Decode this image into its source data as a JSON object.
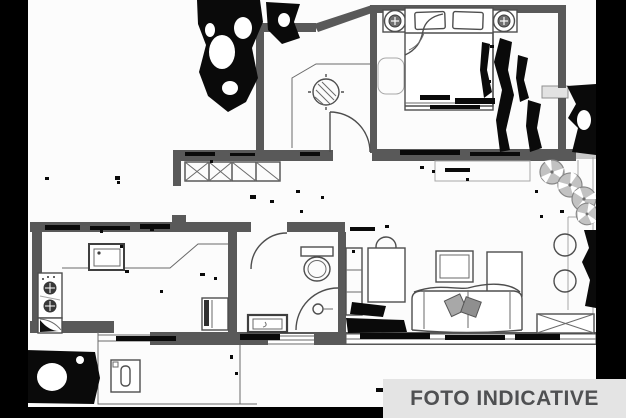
{
  "watermark": {
    "label": "FOTO INDICATIVE"
  },
  "colors": {
    "paper": "#fcfcfc",
    "wall": "#595959",
    "line": "#4e4e4e",
    "light_line": "#a8a8a8",
    "noise": "#0a0a0a",
    "banner_bg": "#e4e4e4",
    "banner_text": "#4f5052",
    "scan_border": "#000000",
    "plant_fill": "#c2c2c2",
    "plant_stroke": "#868686"
  }
}
